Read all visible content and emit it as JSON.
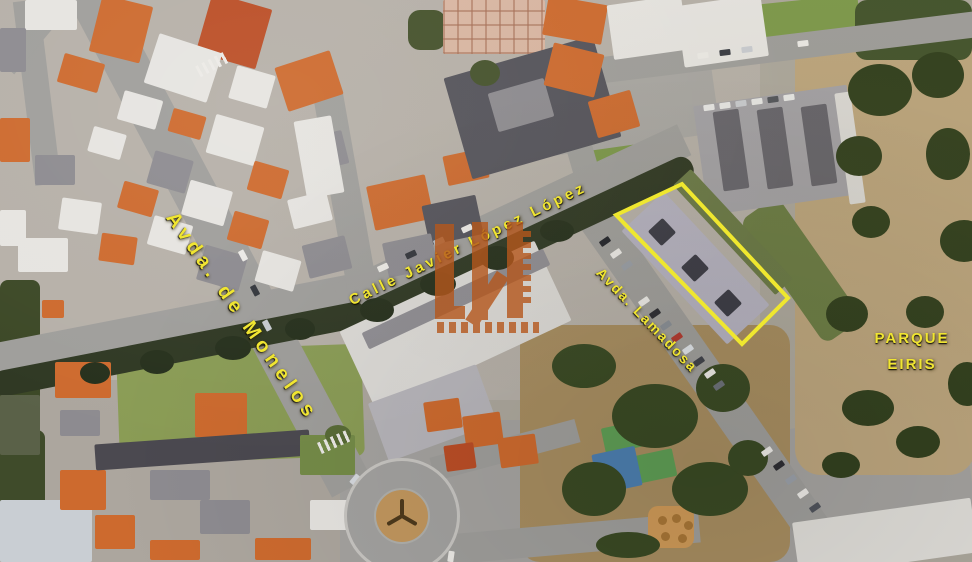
{
  "map": {
    "street_labels": [
      {
        "id": "monelos",
        "text": "Avda. de Monelos"
      },
      {
        "id": "javier-lopez",
        "text": "Calle Javier López López"
      },
      {
        "id": "lamadosa",
        "text": "Avda. Lamadosa"
      }
    ],
    "area_label": {
      "line1": "PARQUE",
      "line2": "EIRIS"
    },
    "label_color": "#f0e532",
    "highlight": {
      "shape": "building-outline",
      "color": "#efe72f"
    },
    "watermark": {
      "color": "#b5571c"
    }
  }
}
